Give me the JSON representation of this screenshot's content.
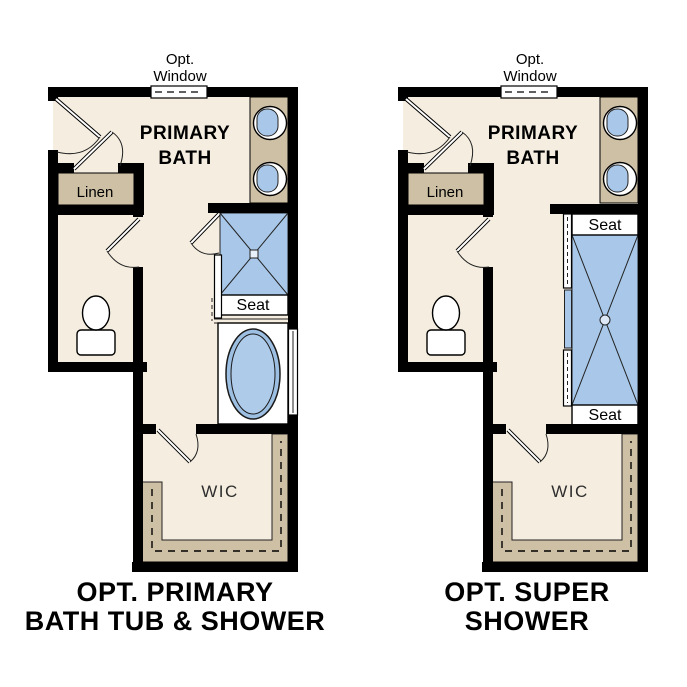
{
  "figure_title": "Primary bath option floor plans",
  "colors": {
    "wall": "#000000",
    "floor": "#f5eee0",
    "cabinet_tan": "#cec0a5",
    "fixture_blue": "#a9c8e9",
    "fixture_white": "#ffffff",
    "text": "#000000"
  },
  "plans": [
    {
      "name": "primary-bath-tub-and-shower",
      "window_note": {
        "line1": "Opt.",
        "line2": "Window"
      },
      "room_label": {
        "line1": "PRIMARY",
        "line2": "BATH"
      },
      "linen_label": "Linen",
      "shower_seat_label": "Seat",
      "wic_label": "WIC",
      "caption": {
        "line1": "OPT. PRIMARY",
        "line2": "BATH TUB & SHOWER"
      }
    },
    {
      "name": "super-shower",
      "window_note": {
        "line1": "Opt.",
        "line2": "Window"
      },
      "room_label": {
        "line1": "PRIMARY",
        "line2": "BATH"
      },
      "linen_label": "Linen",
      "shower_seat_top_label": "Seat",
      "shower_seat_bottom_label": "Seat",
      "wic_label": "WIC",
      "caption": {
        "line1": "OPT. SUPER",
        "line2": "SHOWER"
      }
    }
  ]
}
